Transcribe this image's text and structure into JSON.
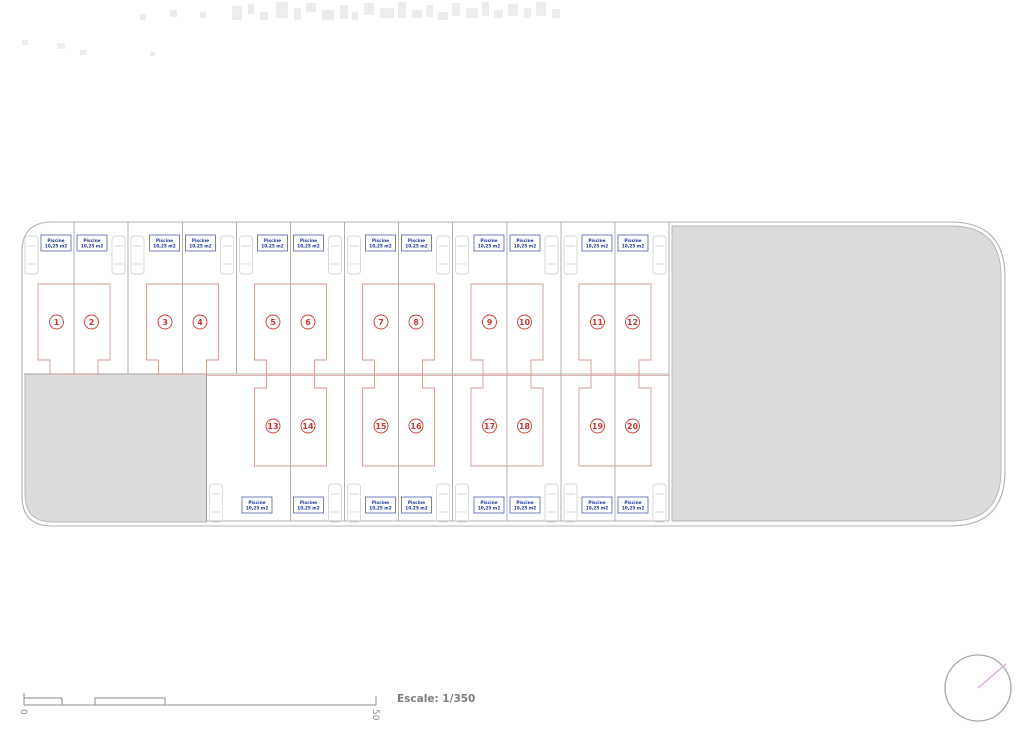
{
  "plan": {
    "pool_label": [
      "Piscine",
      "10,25 m2"
    ],
    "top_plot_numbers": [
      "1",
      "2",
      "3",
      "4",
      "5",
      "6",
      "7",
      "8",
      "9",
      "10",
      "11",
      "12"
    ],
    "bottom_plot_numbers": [
      "13",
      "14",
      "15",
      "16",
      "17",
      "18",
      "19",
      "20"
    ],
    "scale": {
      "label": "Escale: 1/350",
      "start_tick": "0",
      "end_tick": "50"
    },
    "colors": {
      "site_stroke": "#b0b0b0",
      "zone_fill": "#dcdcdc",
      "zone_stroke": "#b5b5b5",
      "plot_line": "#9c9c9c",
      "house_line": "#cf9a94",
      "number_red": "#c43b31",
      "pool_border": "#4f5fae",
      "pool_text": "#1e3799",
      "car_line": "#d6d6d6",
      "scalebar": "#8a8a8a",
      "scale_text": "#7c7c7c",
      "north_circle": "#a8a8a8",
      "north_needle": "#d5a6d8",
      "watermark": "#ededed"
    }
  }
}
